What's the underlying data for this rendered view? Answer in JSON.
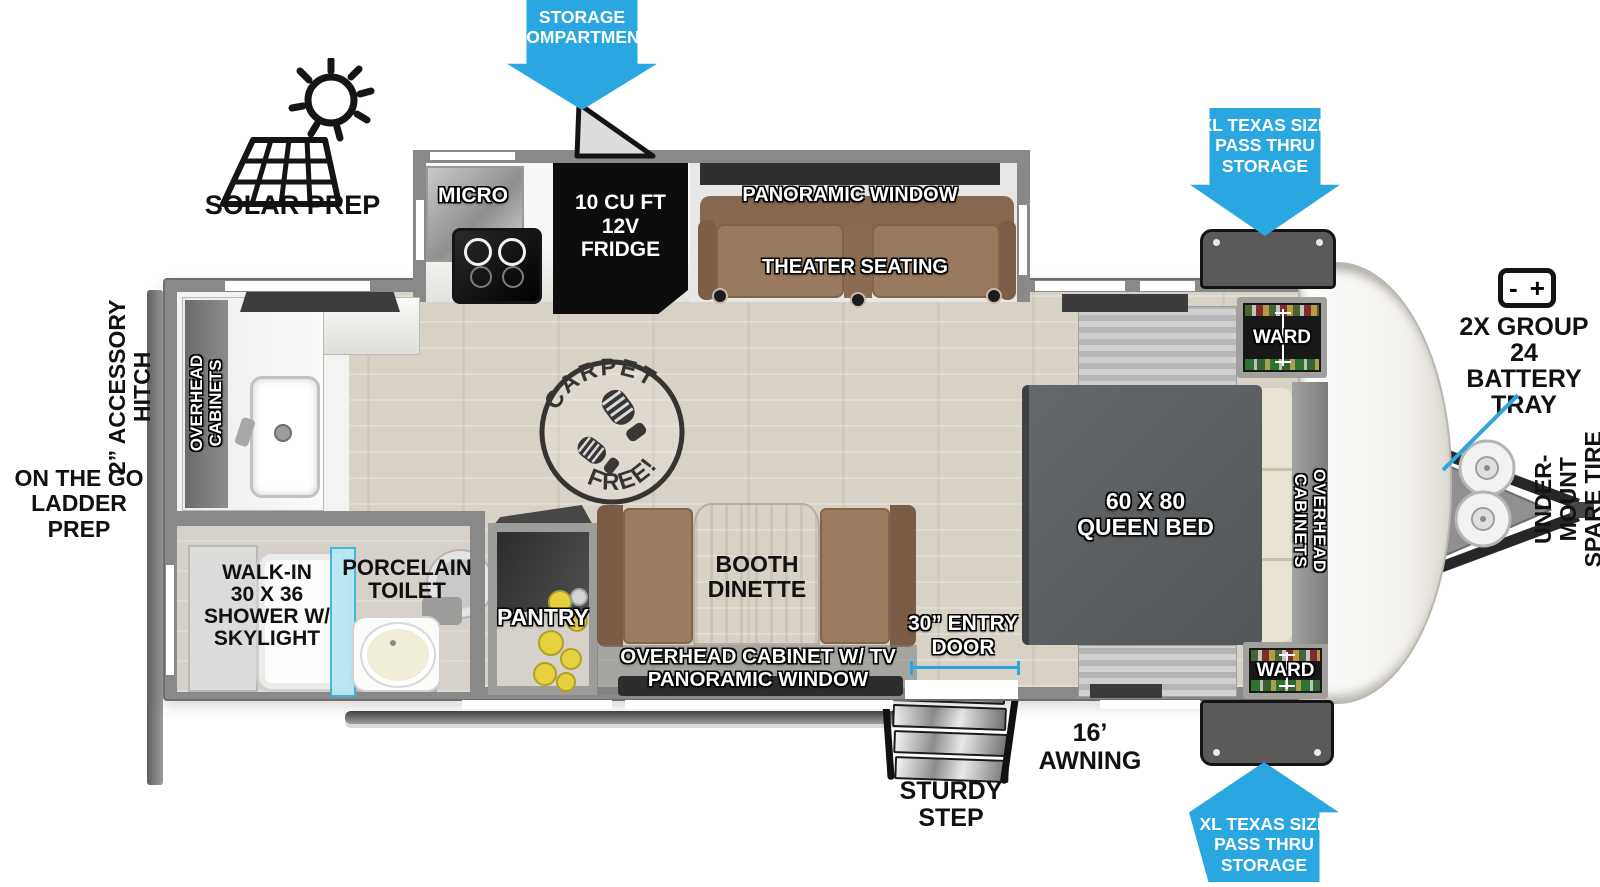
{
  "title": "Travel trailer floorplan diagram",
  "colors": {
    "arrow_blue": "#2aa7e1",
    "wall_gray": "#898989",
    "floor_wood": "#d8d2c6",
    "bed_gray": "#595d60",
    "sofa_brown": "#997a5e",
    "shower_glass": "#b7e8f4",
    "pantry_cans": "#e6d23e",
    "fridge_black": "#0d0d0d"
  },
  "exterior": {
    "solar_prep_label": "SOLAR PREP",
    "storage_compartment_arrow": "STORAGE\nCOMPARTMENT",
    "pass_thru_storage_top": "XL TEXAS SIZE\nPASS THRU\nSTORAGE",
    "pass_thru_storage_bottom": "XL TEXAS SIZE\nPASS THRU\nSTORAGE",
    "battery_tray": "2X GROUP 24\nBATTERY\nTRAY",
    "battery_minus": "-",
    "battery_plus": "+",
    "under_mount_spare_tire": "UNDER-MOUNT\nSPARE TIRE",
    "accessory_hitch": "2” ACCESSORY\nHITCH",
    "ladder_prep": "ON THE GO\nLADDER PREP",
    "awning": "16’ AWNING",
    "sturdy_step": "STURDY\nSTEP",
    "entry_door": "30” ENTRY\nDOOR"
  },
  "interior": {
    "micro": "MICRO",
    "fridge": "10 CU FT\n12V\nFRIDGE",
    "panoramic_window_top": "PANORAMIC WINDOW",
    "theater_seating": "THEATER SEATING",
    "ward_front_top": "WARD",
    "ward_front_bottom": "WARD",
    "overhead_cabinets_bedroom": "OVERHEAD CABINETS",
    "overhead_cabinets_rear": "OVERHEAD\nCABINETS",
    "queen_bed": "60 X 80\nQUEEN BED",
    "booth_dinette": "BOOTH\nDINETTE",
    "pantry": "PANTRY",
    "overhead_cabinet_tv": "OVERHEAD CABINET W/ TV",
    "panoramic_window_bottom": "PANORAMIC WINDOW",
    "porcelain_toilet": "PORCELAIN\nTOILET",
    "shower": "WALK-IN\n30 X 36\nSHOWER W/\nSKYLIGHT",
    "carpet_free": {
      "top": "CARPET",
      "bottom": "FREE!"
    }
  }
}
